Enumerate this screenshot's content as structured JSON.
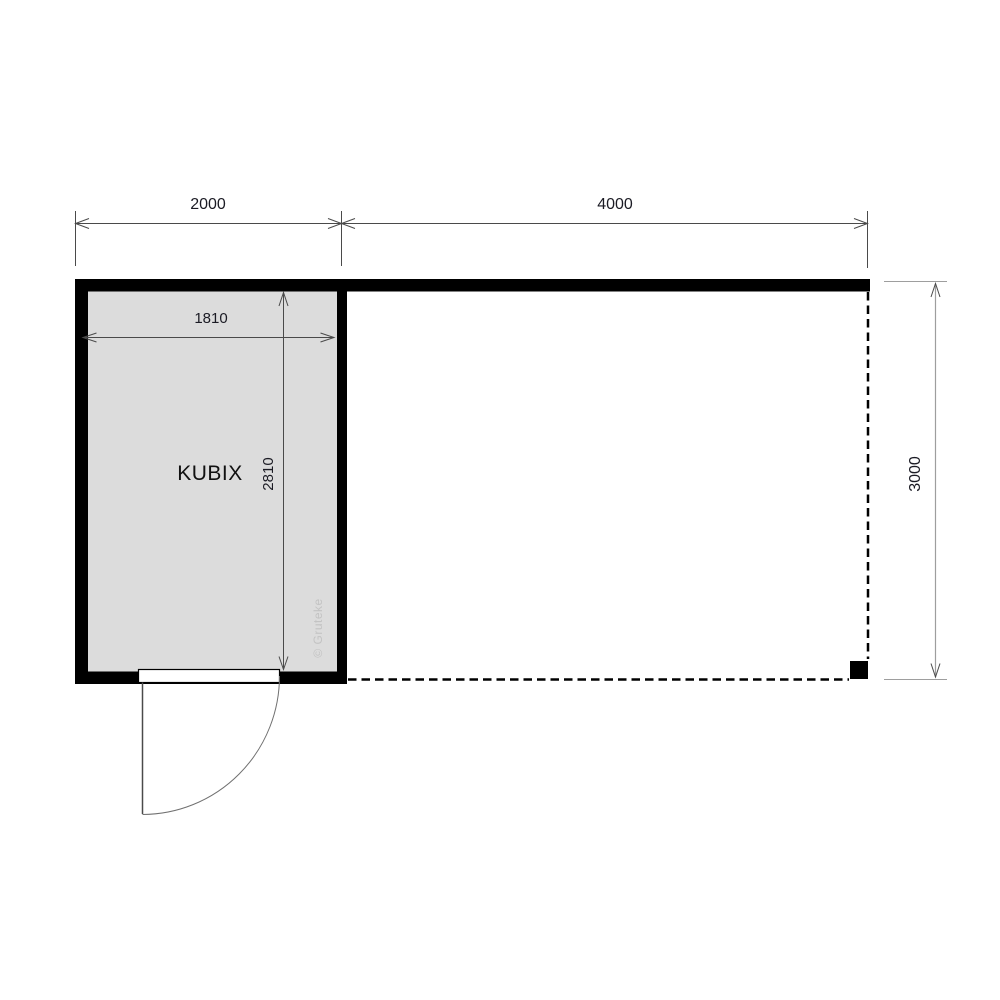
{
  "plan": {
    "room_label": "KUBIX",
    "watermark": "© Gruteke",
    "dims": {
      "room_outer_width": "2000",
      "canopy_width": "4000",
      "room_inner_width": "1810",
      "room_inner_depth": "2810",
      "overall_depth": "3000"
    },
    "colors": {
      "wall": "#000000",
      "room_fill": "#dcdcdc",
      "dimension_text": "#1b1b24",
      "dimension_line": "#4a4a4a",
      "light_dimension_line": "#9e9e9e",
      "door_line": "#555555",
      "watermark_text": "#c3c3c3",
      "background": "#ffffff"
    }
  }
}
